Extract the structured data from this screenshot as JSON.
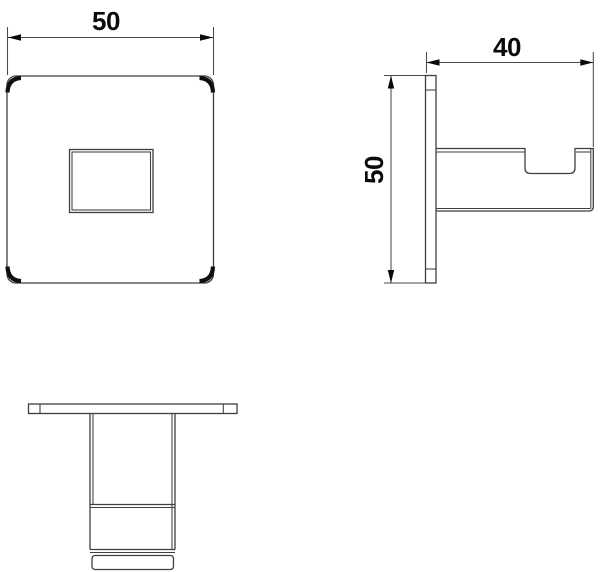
{
  "colors": {
    "background": "#ffffff",
    "geometry_line": "#3f3f3f",
    "dimension_line": "#4a4a4a",
    "text": "#0a0a0a",
    "fillet_mark": "#101010"
  },
  "dimensions": {
    "front_width": "50",
    "side_depth": "40",
    "side_height": "50"
  }
}
